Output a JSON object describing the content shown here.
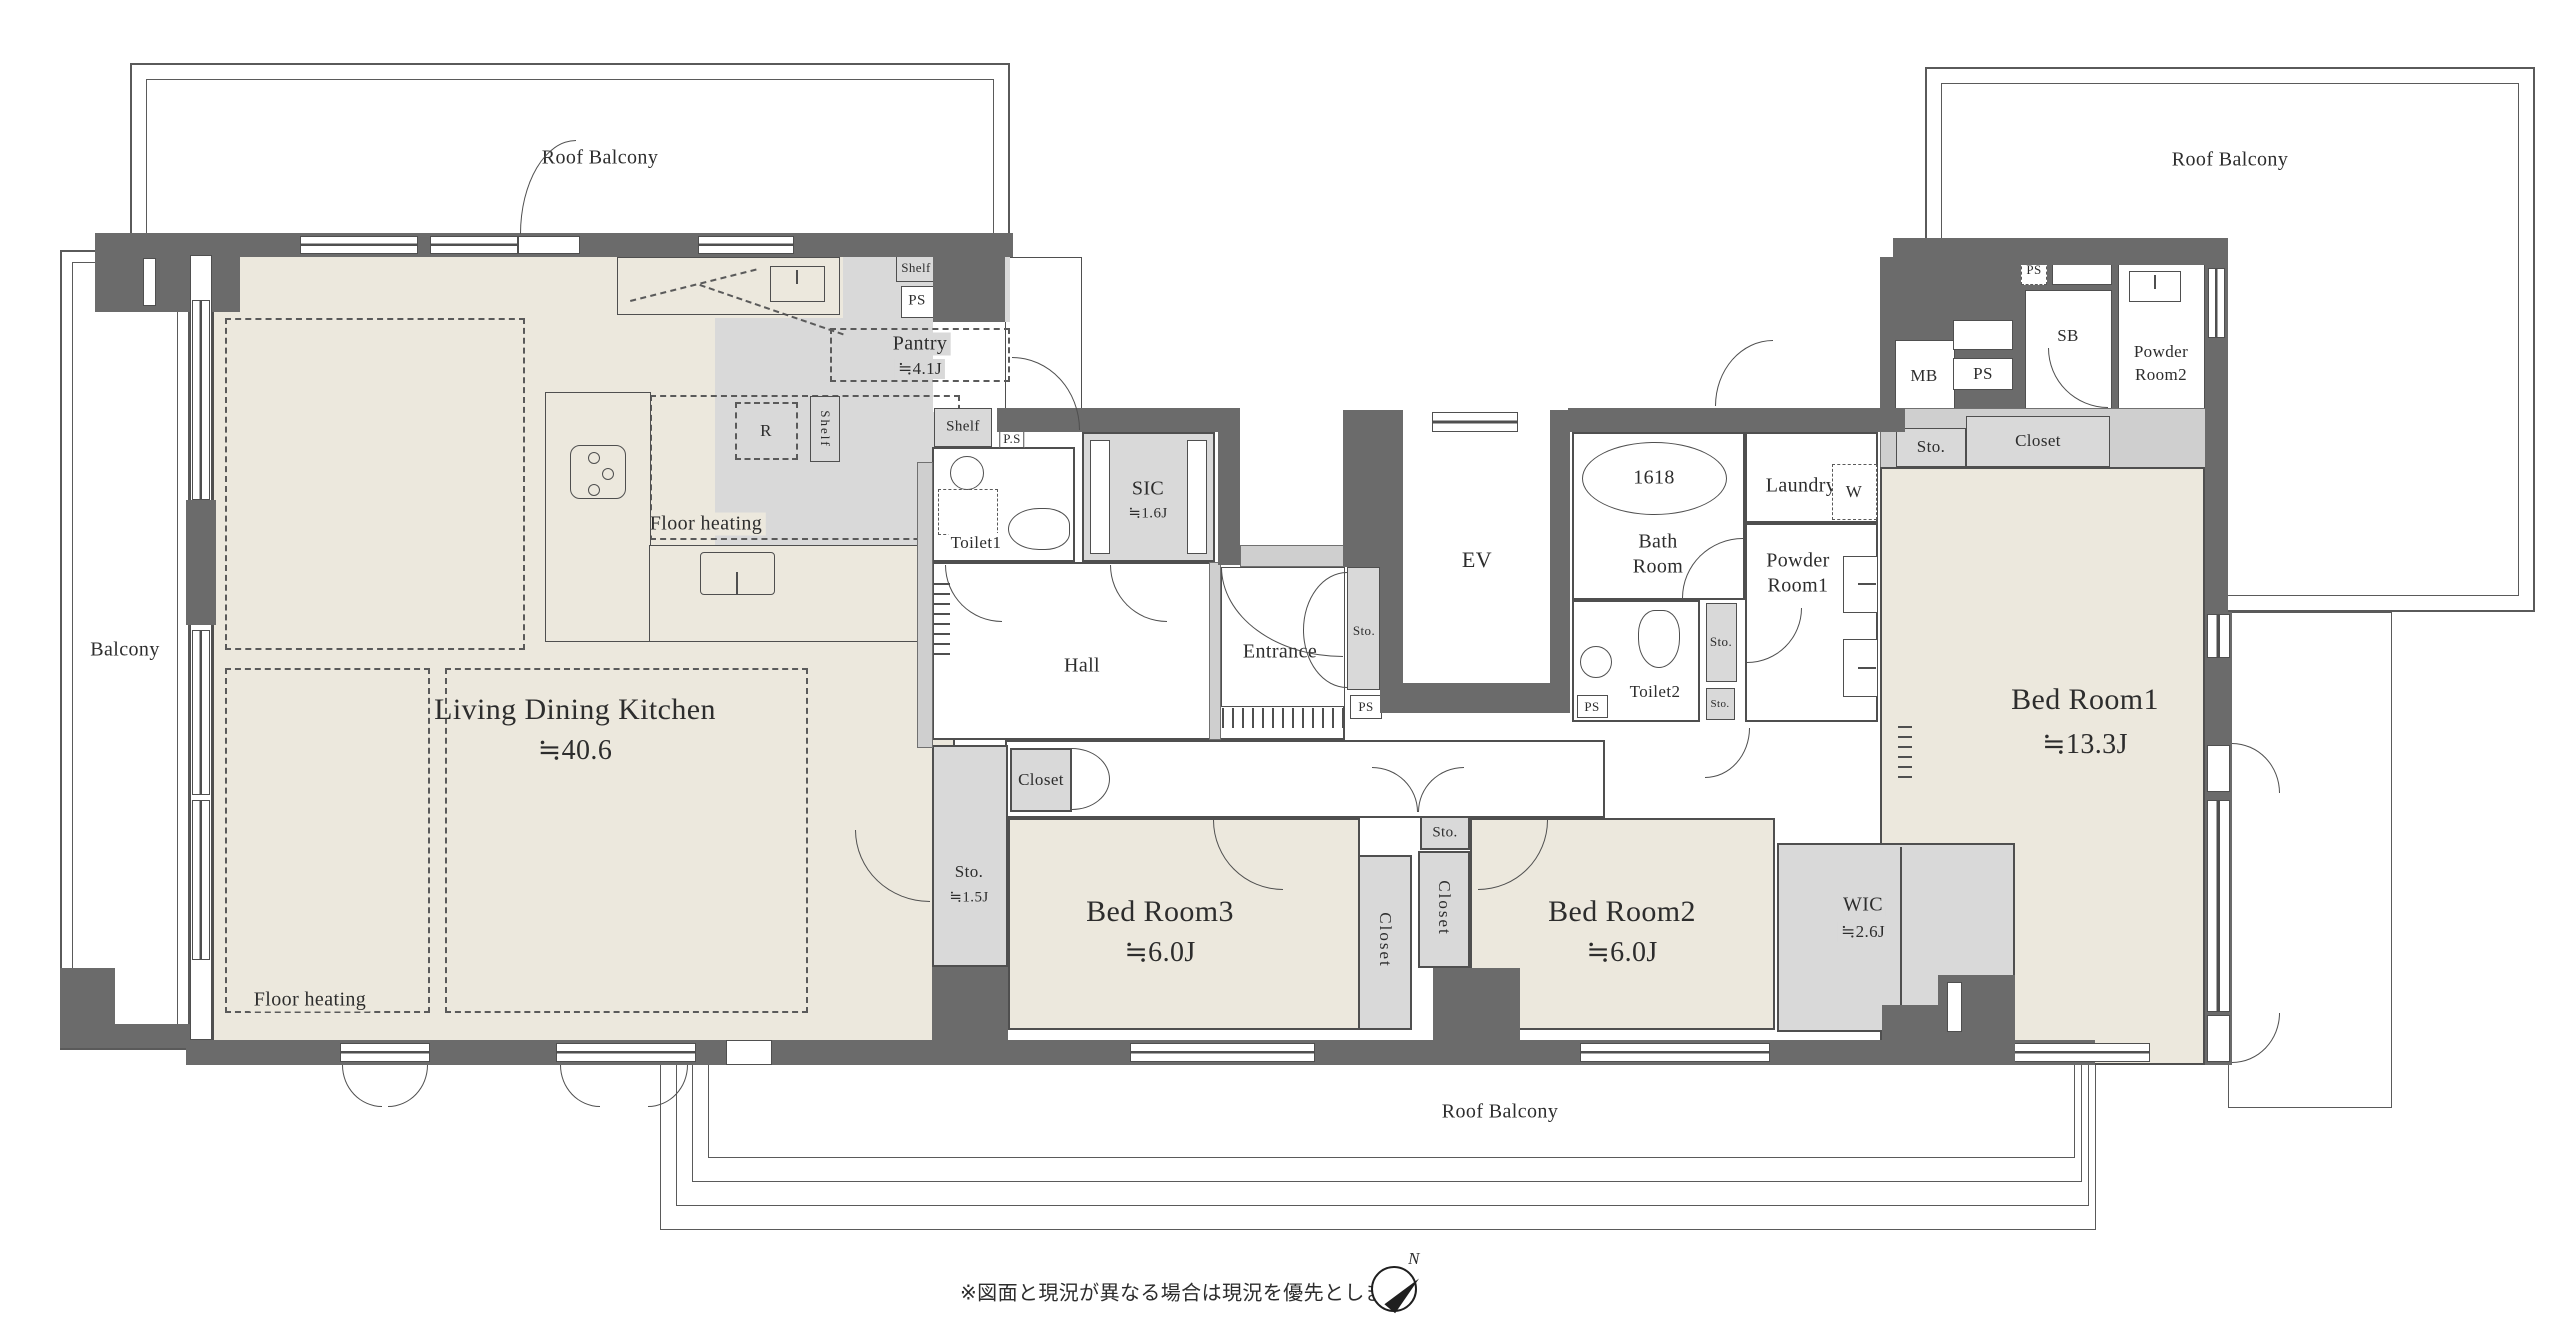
{
  "colors": {
    "wall": "#6b6b6b",
    "floor": "#ece8dd",
    "storage_floor": "#d9d9d9",
    "line": "#4f4f4f",
    "background": "#ffffff"
  },
  "rooms": {
    "ldk": {
      "name": "Living Dining Kitchen",
      "size": "≒40.6"
    },
    "bed1": {
      "name": "Bed Room1",
      "size": "≒13.3J"
    },
    "bed2": {
      "name": "Bed Room2",
      "size": "≒6.0J"
    },
    "bed3": {
      "name": "Bed Room3",
      "size": "≒6.0J"
    },
    "wic": {
      "name": "WIC",
      "size": "≒2.6J"
    },
    "sic": {
      "name": "SIC",
      "size": "≒1.6J"
    },
    "pantry": {
      "name": "Pantry",
      "size": "≒4.1J"
    },
    "sto_hall": {
      "name": "Sto.",
      "size": "≒1.5J"
    },
    "hall": {
      "name": "Hall"
    },
    "entrance": {
      "name": "Entrance"
    },
    "ev": {
      "name": "EV"
    },
    "bath": {
      "name": "Bath",
      "name2": "Room"
    },
    "toilet1": {
      "name": "Toilet1"
    },
    "toilet2": {
      "name": "Toilet2"
    },
    "laundry": {
      "name": "Laundry"
    },
    "powder1": {
      "name": "Powder",
      "name2": "Room1"
    },
    "powder2": {
      "name": "Powder",
      "name2": "Room2"
    }
  },
  "labels": {
    "roof_balcony": "Roof Balcony",
    "balcony": "Balcony",
    "floor_heating": "Floor heating",
    "shelf": "Shelf",
    "ps": "PS",
    "ps_dotted": "P.S",
    "sto": "Sto.",
    "closet": "Closet",
    "r": "R",
    "w": "W",
    "mb": "MB",
    "sb": "SB",
    "tub": "1618",
    "north": "N"
  },
  "footer": {
    "note": "※図面と現況が異なる場合は現況を優先とします。"
  }
}
